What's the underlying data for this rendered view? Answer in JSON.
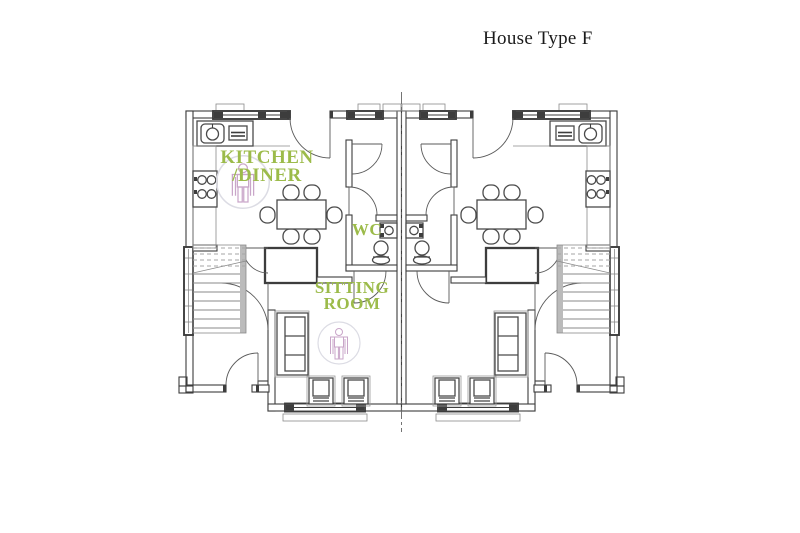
{
  "title": "House Type F",
  "labels": {
    "kitchen_line1": "KITCHEN",
    "kitchen_line2": "/DINER",
    "wc": "WC",
    "sitting_line1": "SITTING",
    "sitting_line2": "ROOM"
  },
  "colors": {
    "background": "#ffffff",
    "title_text": "#1a1a1a",
    "label_green": "#9cbb4a",
    "wall": "#3d3d3d",
    "wall_light": "#8a8a8a",
    "accessibility_symbol": "#c9a6c9",
    "symbol_circle": "#dcdce4"
  }
}
